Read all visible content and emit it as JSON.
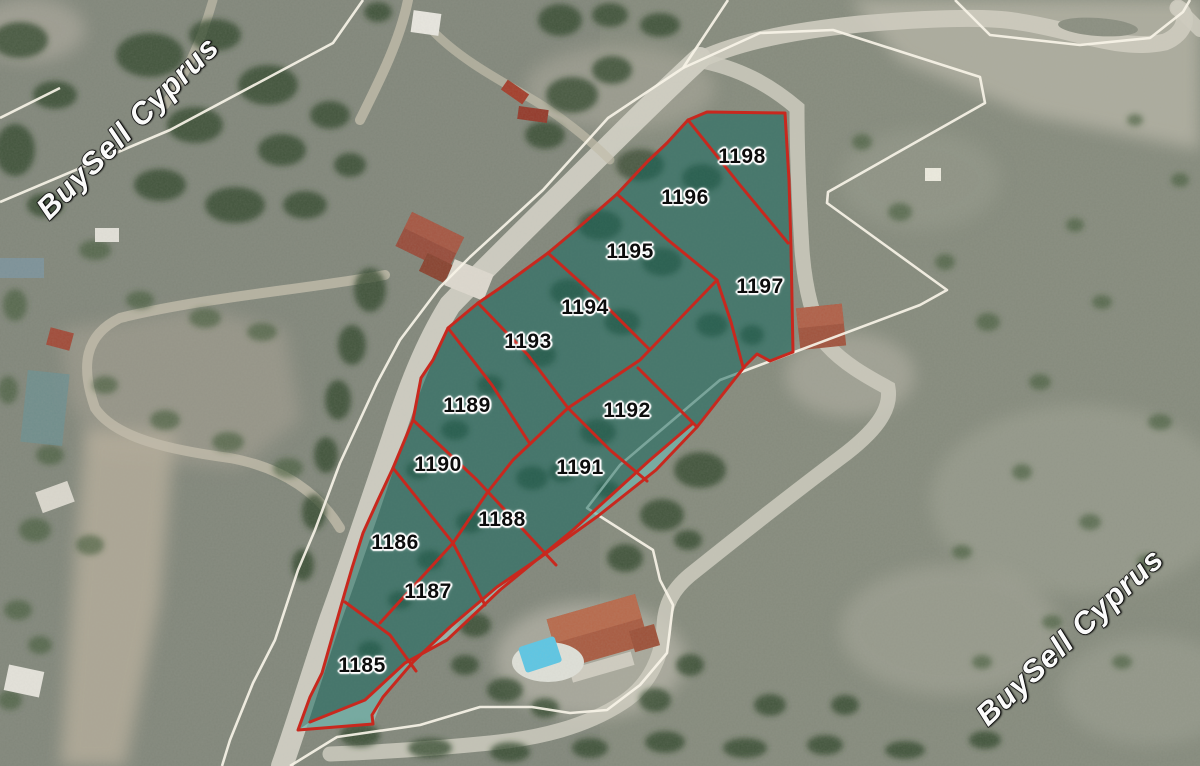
{
  "watermark": {
    "text": "BuySell Cyprus",
    "color": "#ffffff",
    "outline_color": "#1c1c1c"
  },
  "map": {
    "type": "satellite-cadastral",
    "overlay": {
      "parcel_fill": "#10655c",
      "strip_fill": "#a8ded6",
      "boundary_color": "#c8281e",
      "cadastral_line_color": "#f7f3e7",
      "label_color": "#0c0c0c",
      "label_halo": "#ffffff"
    },
    "parcels": [
      {
        "id": "1185",
        "x": 362,
        "y": 666
      },
      {
        "id": "1186",
        "x": 395,
        "y": 543
      },
      {
        "id": "1187",
        "x": 428,
        "y": 592
      },
      {
        "id": "1188",
        "x": 502,
        "y": 520
      },
      {
        "id": "1189",
        "x": 467,
        "y": 406
      },
      {
        "id": "1190",
        "x": 438,
        "y": 465
      },
      {
        "id": "1191",
        "x": 580,
        "y": 468
      },
      {
        "id": "1192",
        "x": 627,
        "y": 411
      },
      {
        "id": "1193",
        "x": 528,
        "y": 342
      },
      {
        "id": "1194",
        "x": 585,
        "y": 308
      },
      {
        "id": "1195",
        "x": 630,
        "y": 252
      },
      {
        "id": "1196",
        "x": 685,
        "y": 198
      },
      {
        "id": "1197",
        "x": 760,
        "y": 287
      },
      {
        "id": "1198",
        "x": 742,
        "y": 157
      }
    ]
  }
}
